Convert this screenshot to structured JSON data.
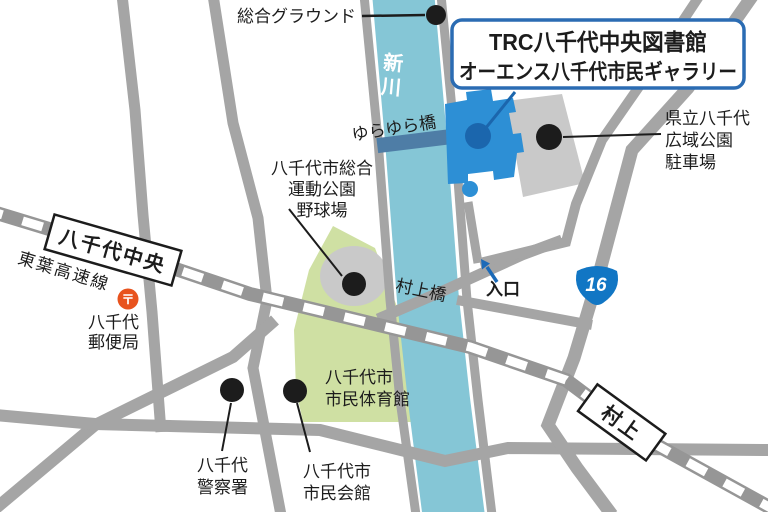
{
  "title_box": {
    "line1": "TRC八千代中央図書館",
    "line2": "オーエンス八千代市民ギャラリー"
  },
  "stations": {
    "yachiyo_chuo": "八千代中央",
    "murakami": "村上",
    "line_name": "東葉高速線"
  },
  "river": {
    "char1": "新",
    "char2": "川"
  },
  "bridges": {
    "yurayura": "ゆらゆら橋",
    "murakami": "村上橋"
  },
  "route_sign": {
    "number": "16"
  },
  "entrance": {
    "label": "入口"
  },
  "post_office": {
    "mark": "〒",
    "line1": "八千代",
    "line2": "郵便局"
  },
  "places": {
    "sogo_ground": "総合グラウンド",
    "parking": {
      "l1": "県立八千代",
      "l2": "広域公園",
      "l3": "駐車場"
    },
    "sports_park": {
      "l1": "八千代市総合",
      "l2": "運動公園",
      "l3": "野球場"
    },
    "gym": {
      "l1": "八千代市",
      "l2": "市民体育館"
    },
    "police": {
      "l1": "八千代",
      "l2": "警察署"
    },
    "civic_hall": {
      "l1": "八千代市",
      "l2": "市民会館"
    }
  },
  "colors": {
    "river": "#85c6d6",
    "park_green": "#cfe0a3",
    "road": "#a5a5a5",
    "railway": "#969696",
    "library_blue": "#2d8fd5",
    "accent_dark_blue": "#1b66ad",
    "title_blue": "#2b6cb3",
    "route_shield_blue": "#1176c4",
    "entrance_blue": "#1b6ab8",
    "post_red": "#e8531e",
    "building_gray": "#c9c9c9",
    "yurayura_blue": "#4e7da6",
    "label_black": "#1c1c1c"
  }
}
